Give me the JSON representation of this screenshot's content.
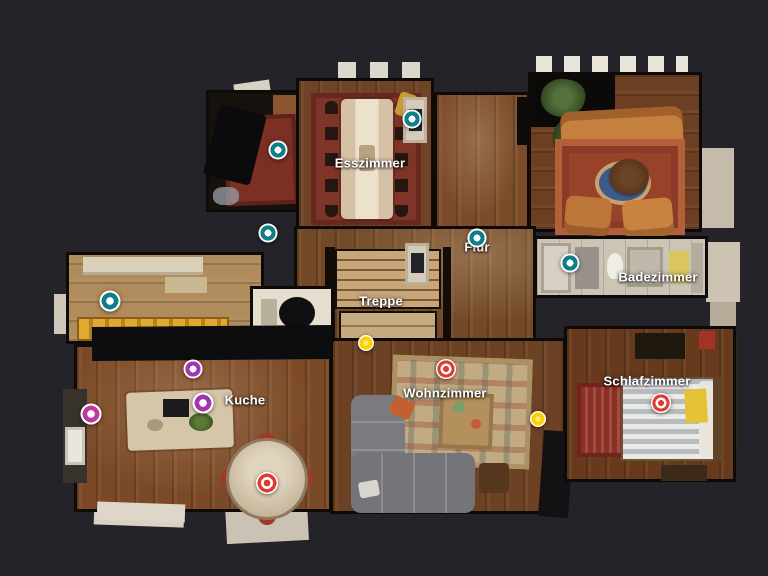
{
  "canvas": {
    "background": "#232329"
  },
  "colors": {
    "teal": "#0f7e86",
    "purple": "#a136b0",
    "magenta": "#c3389f",
    "yellow": "#fdd000",
    "red": "#e13b30",
    "label_text": "#ffffff"
  },
  "rooms": [
    {
      "id": "esszimmer",
      "label": "Esszimmer",
      "x": 370,
      "y": 163
    },
    {
      "id": "flur",
      "label": "Flur",
      "x": 477,
      "y": 247
    },
    {
      "id": "treppe",
      "label": "Treppe",
      "x": 381,
      "y": 301
    },
    {
      "id": "badezimmer",
      "label": "Badezimmer",
      "x": 658,
      "y": 277
    },
    {
      "id": "kuche",
      "label": "Kuche",
      "x": 245,
      "y": 400
    },
    {
      "id": "wohnzimmer",
      "label": "Wohnzimmer",
      "x": 445,
      "y": 393
    },
    {
      "id": "schlafzimmer",
      "label": "Schlafzimmer",
      "x": 647,
      "y": 381
    }
  ],
  "markers": [
    {
      "id": "marker-teal-piano-room",
      "color": "teal",
      "style": "ring",
      "x": 278,
      "y": 150,
      "size": 19
    },
    {
      "id": "marker-teal-esszimmer",
      "color": "teal",
      "style": "ring",
      "x": 412,
      "y": 119,
      "size": 19
    },
    {
      "id": "marker-teal-hall-west",
      "color": "teal",
      "style": "ring",
      "x": 268,
      "y": 233,
      "size": 19
    },
    {
      "id": "marker-teal-flur",
      "color": "teal",
      "style": "ring",
      "x": 477,
      "y": 238,
      "size": 19
    },
    {
      "id": "marker-teal-badezimmer",
      "color": "teal",
      "style": "ring",
      "x": 570,
      "y": 263,
      "size": 19
    },
    {
      "id": "marker-teal-pantry",
      "color": "teal",
      "style": "ring",
      "x": 110,
      "y": 301,
      "size": 21
    },
    {
      "id": "marker-purple-kuche-north",
      "color": "purple",
      "style": "ring",
      "x": 193,
      "y": 369,
      "size": 19
    },
    {
      "id": "marker-purple-kuche-island",
      "color": "purple",
      "style": "ring",
      "x": 203,
      "y": 403,
      "size": 21
    },
    {
      "id": "marker-magenta-kuche-west",
      "color": "magenta",
      "style": "ring",
      "x": 91,
      "y": 414,
      "size": 21
    },
    {
      "id": "marker-yellow-treppe",
      "color": "yellow",
      "style": "solid",
      "x": 366,
      "y": 343,
      "size": 16
    },
    {
      "id": "marker-yellow-wohnzimmer",
      "color": "yellow",
      "style": "solid",
      "x": 538,
      "y": 419,
      "size": 16
    },
    {
      "id": "marker-red-wohnzimmer",
      "color": "red",
      "style": "target",
      "x": 446,
      "y": 369,
      "size": 20
    },
    {
      "id": "marker-red-schlafzimmer",
      "color": "red",
      "style": "target",
      "x": 661,
      "y": 403,
      "size": 20
    },
    {
      "id": "marker-red-kuche-table",
      "color": "red",
      "style": "target",
      "x": 267,
      "y": 483,
      "size": 22
    }
  ]
}
